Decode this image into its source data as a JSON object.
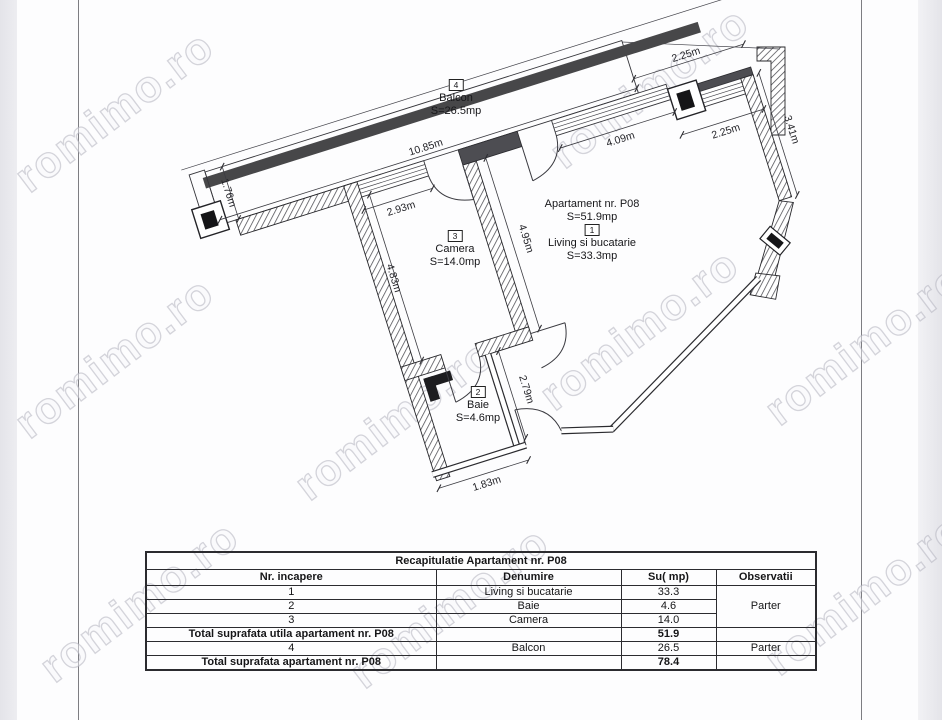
{
  "watermark": {
    "text": "romimo.ro"
  },
  "plan": {
    "apartment_title": "Apartament nr. P08",
    "apartment_area": "S=51.9mp",
    "rooms": {
      "balcon": {
        "num": "4",
        "name": "Balcon",
        "area": "S=26.5mp"
      },
      "living": {
        "num": "1",
        "name": "Living si bucatarie",
        "area": "S=33.3mp"
      },
      "camera": {
        "num": "3",
        "name": "Camera",
        "area": "S=14.0mp"
      },
      "baie": {
        "num": "2",
        "name": "Baie",
        "area": "S=4.6mp"
      }
    },
    "dims": {
      "balcony_length": "10.85m",
      "balcony_width": "1.76m",
      "camera_window": "2.93m",
      "camera_depth": "4.83m",
      "partition": "4.95m",
      "living_window": "4.09m",
      "right_top": "2.25m",
      "right_mid": "2.25m",
      "right_wall": "3.41m",
      "baie_depth": "2.79m",
      "baie_width": "1.83m"
    }
  },
  "table": {
    "title": "Recapitulatie Apartament nr. P08",
    "headers": [
      "Nr. incapere",
      "Denumire",
      "Su( mp)",
      "Observatii"
    ],
    "rows": [
      {
        "nr": "1",
        "name": "Living si bucatarie",
        "su": "33.3"
      },
      {
        "nr": "2",
        "name": "Baie",
        "su": "4.6"
      },
      {
        "nr": "3",
        "name": "Camera",
        "su": "14.0"
      }
    ],
    "rooms_observatii": "Parter",
    "total_utila_label": "Total suprafata utila apartament nr. P08",
    "total_utila_value": "51.9",
    "balcon_row": {
      "nr": "4",
      "name": "Balcon",
      "su": "26.5",
      "obs": "Parter"
    },
    "total_label": "Total suprafata apartament nr. P08",
    "total_value": "78.4"
  }
}
